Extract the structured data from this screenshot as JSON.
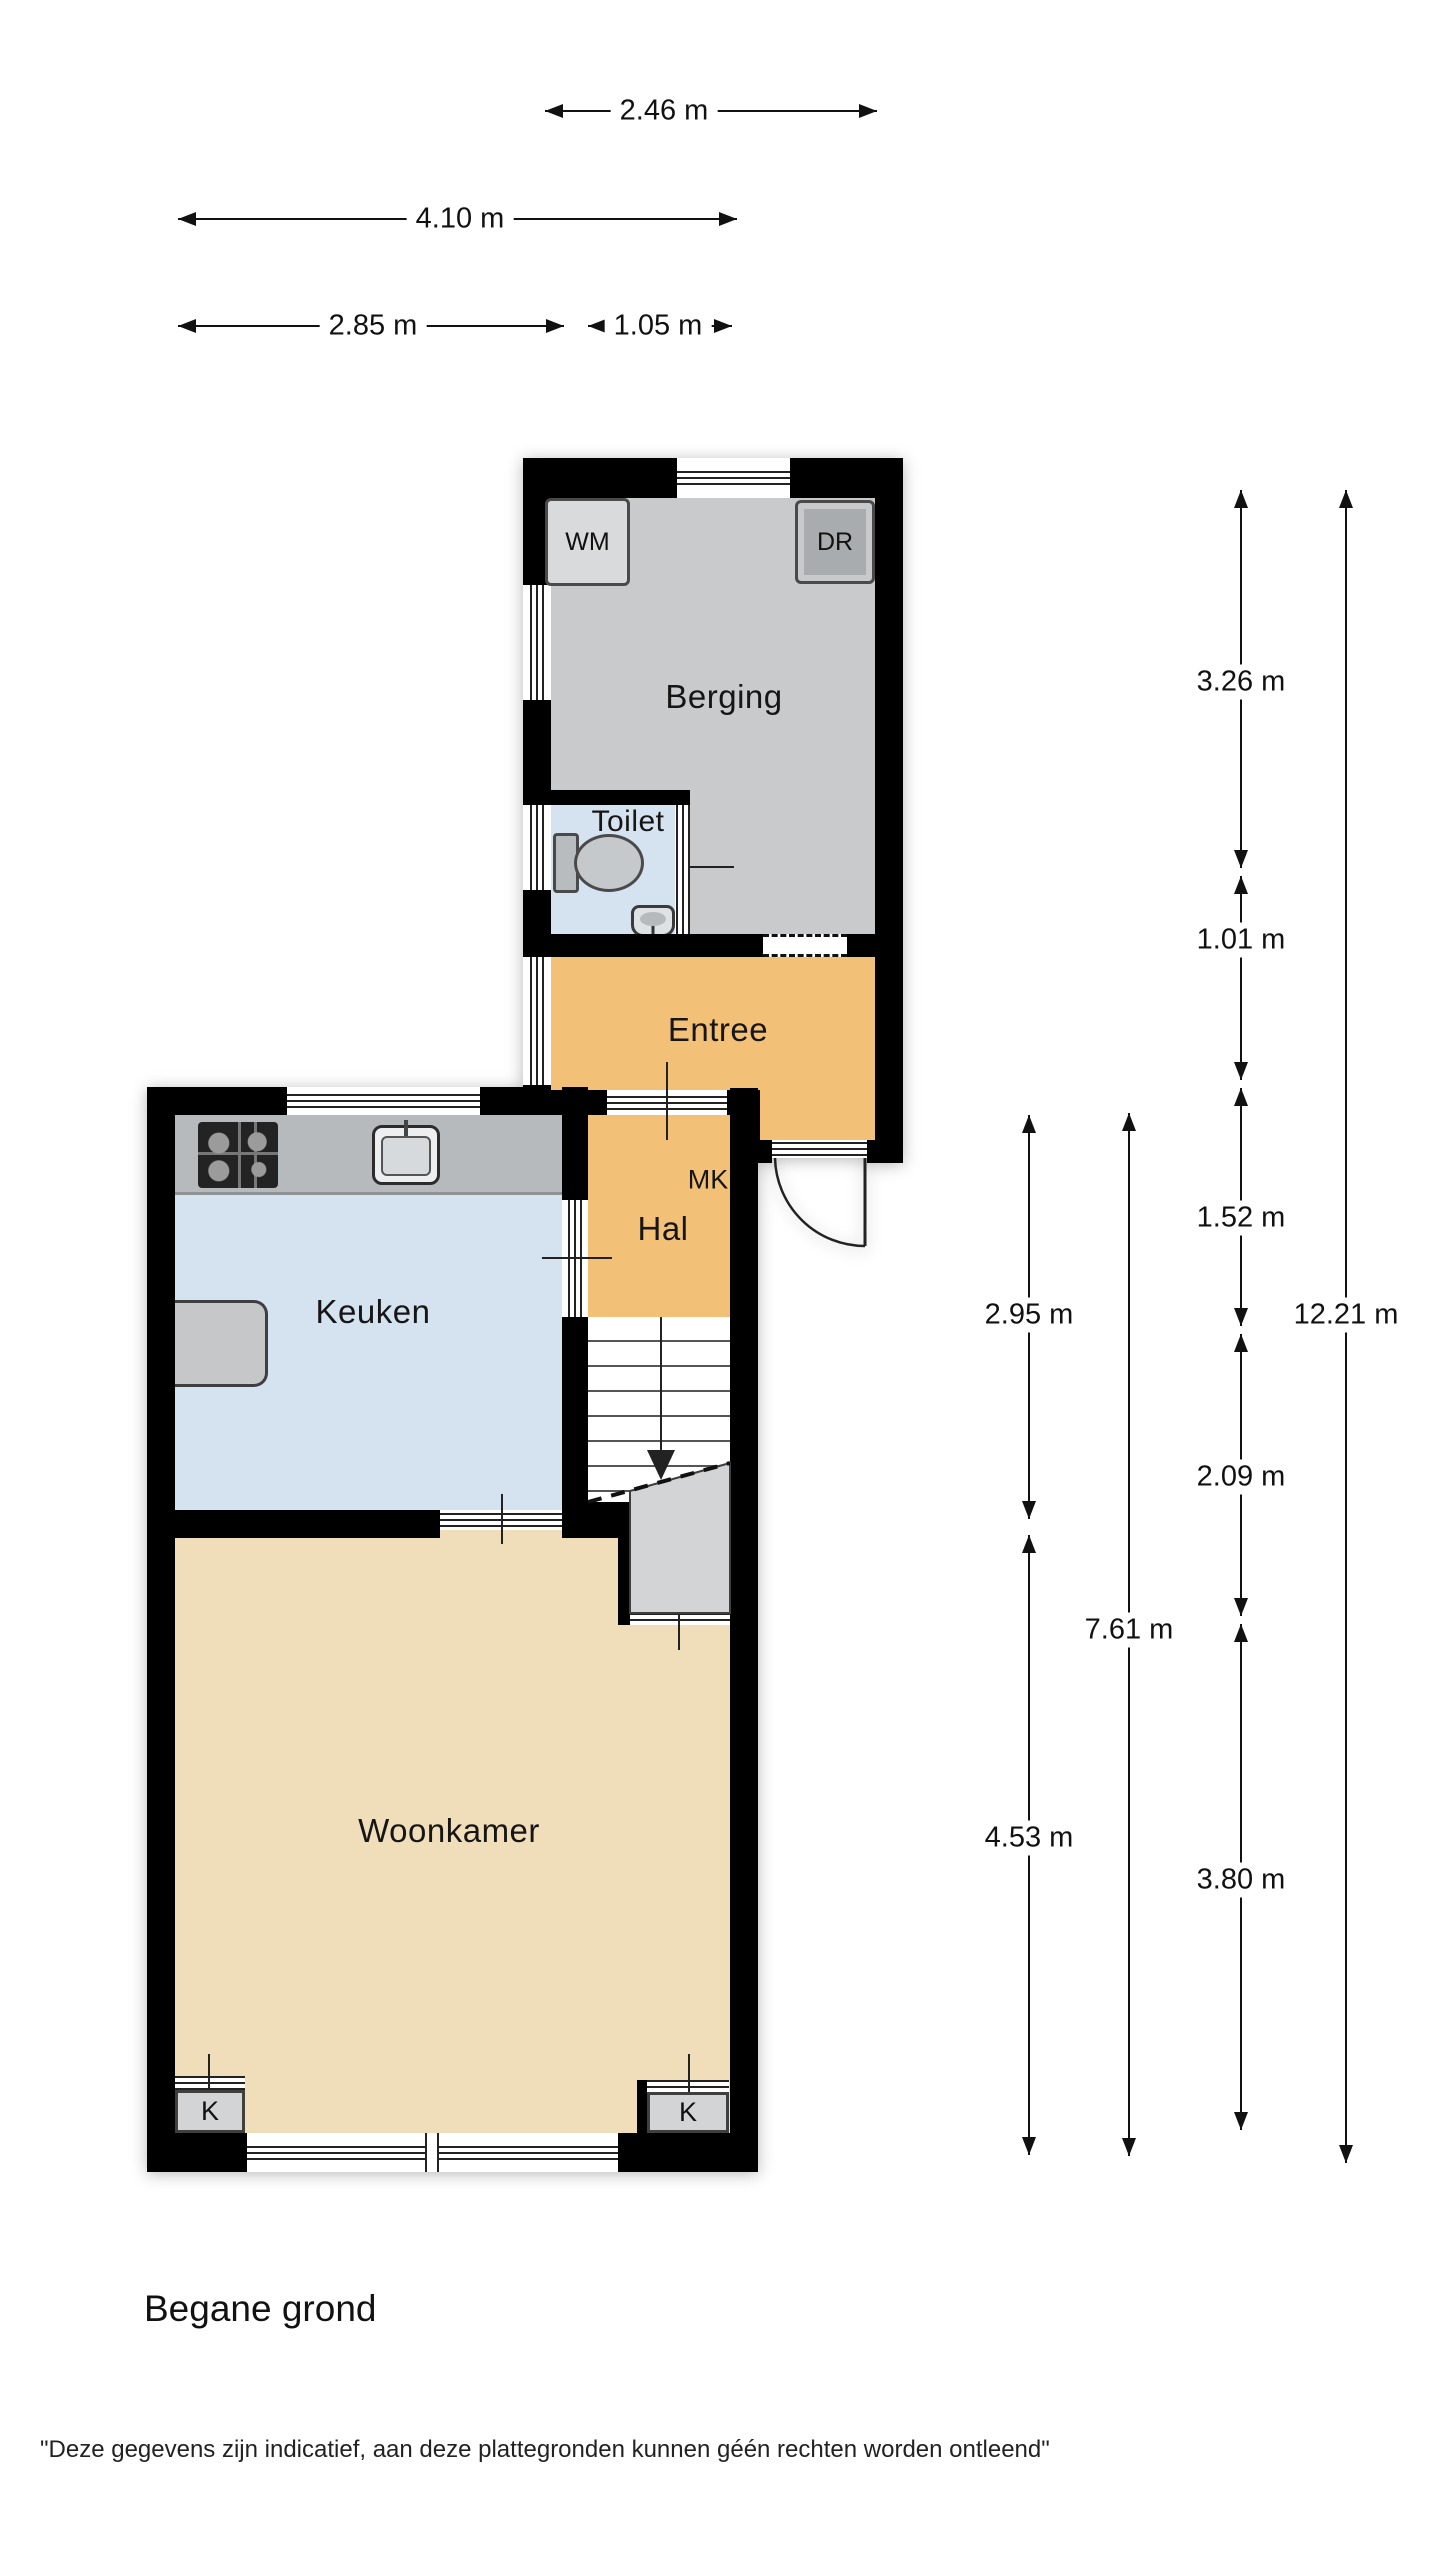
{
  "title": "Begane grond",
  "disclaimer": "\"Deze gegevens zijn indicatief, aan deze plattegronden kunnen géén rechten worden ontleend\"",
  "rooms": {
    "berging": "Berging",
    "toilet": "Toilet",
    "entree": "Entree",
    "hal": "Hal",
    "keuken": "Keuken",
    "woonkamer": "Woonkamer"
  },
  "features": {
    "wm": "WM",
    "dr": "DR",
    "mk": "MK",
    "k": "K"
  },
  "colors": {
    "berging": "#c9cacc",
    "blue": "#d5e3f1",
    "orange": "#f3c078",
    "beige": "#f0debb",
    "closet": "#d3d4d5",
    "counter": "#b7babc",
    "wm": "#d8dadb",
    "dr": "#a9acae"
  },
  "dimensions": {
    "horizontal": [
      {
        "label": "2.46 m",
        "y": 110,
        "x1": 545,
        "x2": 877,
        "lx": 664
      },
      {
        "label": "4.10 m",
        "y": 218,
        "x1": 178,
        "x2": 737,
        "lx": 460
      },
      {
        "label": "2.85 m",
        "y": 325,
        "x1": 178,
        "x2": 564,
        "lx": 373
      },
      {
        "label": "1.05 m",
        "y": 325,
        "x1": 588,
        "x2": 732,
        "lx": 658
      }
    ],
    "vertical": [
      {
        "label": "3.26 m",
        "x": 1240,
        "y1": 490,
        "y2": 868,
        "ly": 682
      },
      {
        "label": "1.01 m",
        "x": 1240,
        "y1": 876,
        "y2": 1080,
        "ly": 940
      },
      {
        "label": "1.52 m",
        "x": 1240,
        "y1": 1088,
        "y2": 1326,
        "ly": 1218
      },
      {
        "label": "2.09 m",
        "x": 1240,
        "y1": 1334,
        "y2": 1616,
        "ly": 1477
      },
      {
        "label": "3.80 m",
        "x": 1240,
        "y1": 1624,
        "y2": 2130,
        "ly": 1880
      },
      {
        "label": "12.21 m",
        "x": 1345,
        "y1": 490,
        "y2": 2163,
        "ly": 1315
      },
      {
        "label": "2.95 m",
        "x": 1028,
        "y1": 1115,
        "y2": 1519,
        "ly": 1315
      },
      {
        "label": "4.53 m",
        "x": 1028,
        "y1": 1535,
        "y2": 2155,
        "ly": 1838
      },
      {
        "label": "7.61 m",
        "x": 1128,
        "y1": 1113,
        "y2": 2156,
        "ly": 1630
      }
    ]
  }
}
